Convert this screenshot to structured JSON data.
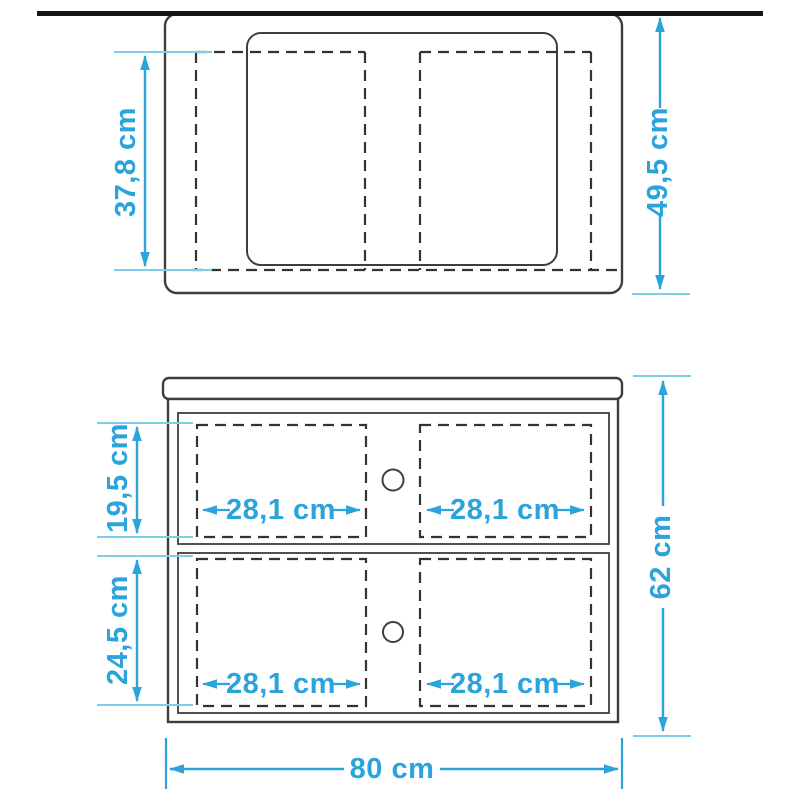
{
  "drawing_title": "vanity-dimension-drawing",
  "colors": {
    "accent": "#2BA3DB",
    "tick": "#7FCDEC",
    "outline": "#3E3E3E",
    "dash": "#333333",
    "wall": "#161616",
    "background": "#FFFFFF"
  },
  "labels": {
    "top_view": {
      "inner_depth": "37,8 cm",
      "total_depth": "49,5 cm"
    },
    "front_view": {
      "drawer_top_height": "19,5 cm",
      "drawer_bottom_height": "24,5 cm",
      "total_height": "62 cm",
      "total_width": "80 cm",
      "drawer_widths": [
        "28,1 cm",
        "28,1 cm",
        "28,1 cm",
        "28,1 cm"
      ]
    }
  }
}
